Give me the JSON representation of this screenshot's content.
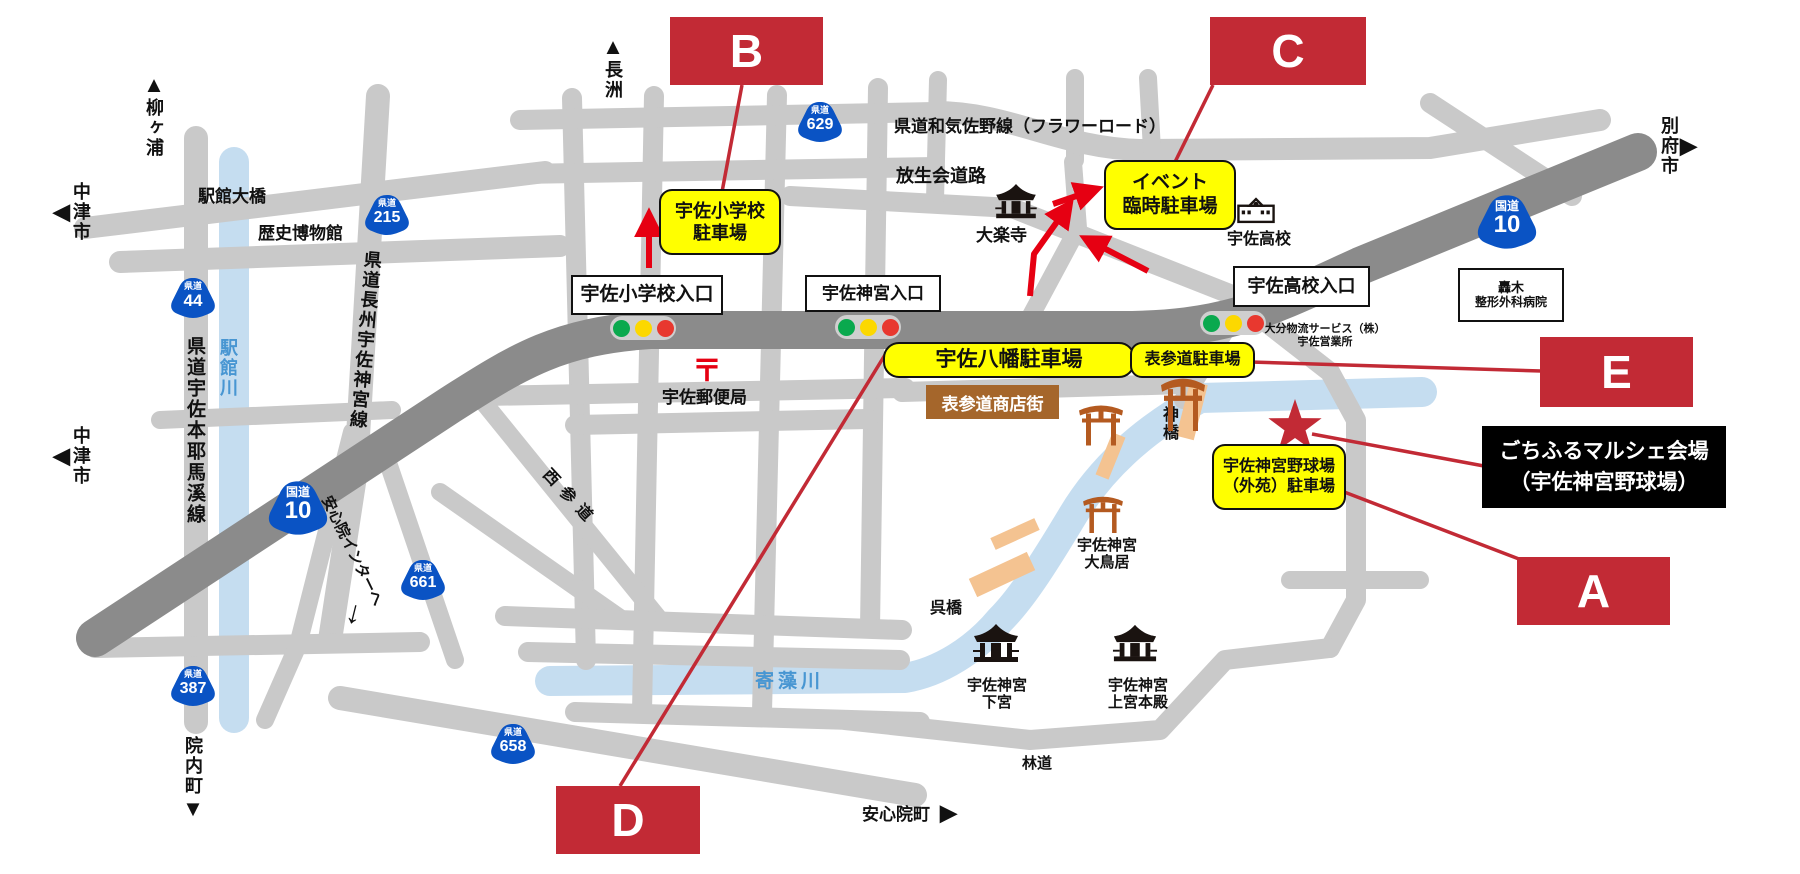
{
  "badges": {
    "a": "A",
    "b": "B",
    "c": "C",
    "d": "D",
    "e": "E"
  },
  "parking": {
    "elementary": [
      "宇佐小学校",
      "駐車場"
    ],
    "event": [
      "イベント",
      "臨時駐車場"
    ],
    "hachiman": "宇佐八幡駐車場",
    "omotesando": "表参道駐車場",
    "gaien": [
      "宇佐神宮野球場",
      "（外苑）駐車場"
    ]
  },
  "venue": [
    "ごちふるマルシェ会場",
    "（宇佐神宮野球場）"
  ],
  "intersections": {
    "elementary": "宇佐小学校入口",
    "jingu": "宇佐神宮入口",
    "highschool": "宇佐高校入口"
  },
  "shields": {
    "k215": {
      "type": "県道",
      "num": "215"
    },
    "k44": {
      "type": "県道",
      "num": "44"
    },
    "k629": {
      "type": "県道",
      "num": "629"
    },
    "k661": {
      "type": "県道",
      "num": "661"
    },
    "k387": {
      "type": "県道",
      "num": "387"
    },
    "k658": {
      "type": "県道",
      "num": "658"
    },
    "r10a": {
      "type": "国道",
      "num": "10"
    },
    "r10b": {
      "type": "国道",
      "num": "10"
    }
  },
  "roads": {
    "flower": "県道和気佐野線（フラワーロード）",
    "hojoe": "放生会道路",
    "ohashi": "駅館大橋",
    "nishisando": "西参道",
    "rindo": "林道",
    "yabakei": "県道宇佐本耶馬溪線",
    "choshu": "県道長州宇佐神宮線",
    "ajimu_ic": "安心院インターへ"
  },
  "rivers": {
    "yakkan": "駅館川",
    "yorimo": "寄藻川"
  },
  "places": {
    "museum": "歴史博物館",
    "dairakuji": "大楽寺",
    "highschool": "宇佐高校",
    "logistics": [
      "大分物流サービス（株）",
      "宇佐営業所"
    ],
    "hospital": [
      "轟木",
      "整形外科病院"
    ],
    "post_office": "宇佐郵便局",
    "post_mark": "〒",
    "shinbashi": "神橋",
    "shopping_street": "表参道商店街",
    "otorii": [
      "宇佐神宮",
      "大鳥居"
    ],
    "kurehashi": "呉橋",
    "gegu": [
      "宇佐神宮",
      "下宮"
    ],
    "jogu": [
      "宇佐神宮",
      "上宮本殿"
    ]
  },
  "directions": {
    "yanagigaura": "柳ヶ浦",
    "nagasu": "長洲",
    "nakatsu": "中津市",
    "beppu": "別府市",
    "innai": "院内町",
    "ajimu": "安心院町",
    "ic_arrow": "↓"
  },
  "arrows": {
    "up": "▲",
    "down": "▼",
    "left": "◀",
    "right": "▶"
  },
  "colors": {
    "badge_red": "#c22a35",
    "label_yellow": "#ffff00",
    "shield_blue": "#0a53c4",
    "river_blue": "#c5ddf0",
    "river_text_blue": "#4896d2",
    "road_gray": "#c9c9c9",
    "road_dark": "#8b8b8b",
    "torii_brown": "#b45a20",
    "bridge_tan": "#f4c391",
    "shop_brown": "#a5662b",
    "arrow_red": "#e60012",
    "signal_green": "#0aa94e",
    "signal_yellow": "#fcd800",
    "signal_red": "#e8382f"
  }
}
